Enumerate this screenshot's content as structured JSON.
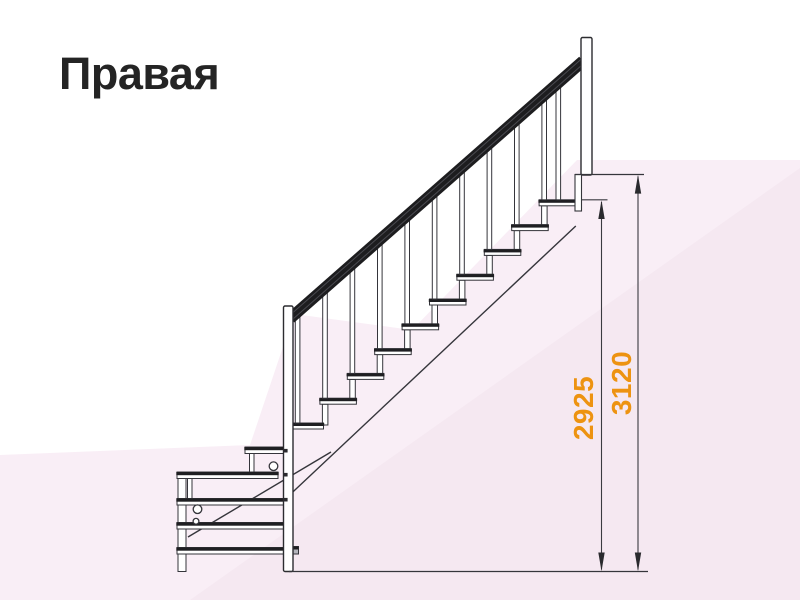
{
  "title": "Правая",
  "diagram": {
    "type": "staircase-side-elevation",
    "dimension_labels": [
      {
        "name": "height-to-top-step",
        "value": "2925"
      },
      {
        "name": "height-to-upper-floor",
        "value": "3120"
      }
    ],
    "counts": {
      "main_flight_steps": 10,
      "lower_winder_steps": 5,
      "balusters": 11
    },
    "colors": {
      "dimension_text": "#ED9311",
      "drawing_line": "#35353b",
      "handrail": "#1d1d1f",
      "title_text": "#242424",
      "background_tint_light": "#f9eef6",
      "background_tint_deep": "#f5e8f1"
    }
  }
}
